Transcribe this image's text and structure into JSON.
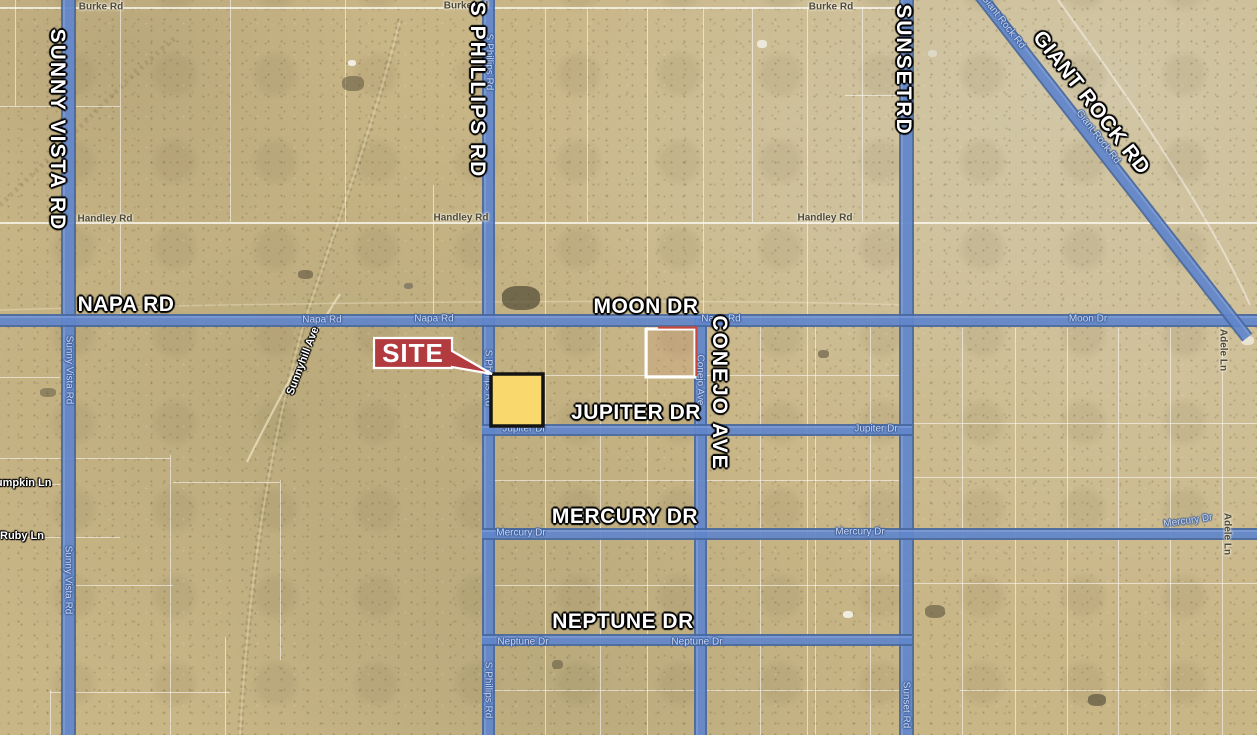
{
  "map": {
    "site_label": "SITE",
    "colors": {
      "desert_base": "#c9b687",
      "road_fill": "#6186cb",
      "road_edge": "#48699f",
      "site_red": "#b23b40",
      "callout_border": "#ffffff",
      "parcel_yellow": "#f9d96d",
      "parcel_yellow_border": "#141414",
      "outlined_parcel_stroke": "#ffffff",
      "outlined_parcel_accent": "#c8473b",
      "grid_white": "#ffffff"
    },
    "major_labels": [
      {
        "text": "SUNNY VISTA RD",
        "x": 57,
        "y": 130,
        "vertical": true
      },
      {
        "text": "S PHILLIPS RD",
        "x": 477,
        "y": 90,
        "vertical": true
      },
      {
        "text": "SUNSETRD",
        "x": 903,
        "y": 70,
        "vertical": true
      },
      {
        "text": "GIANT ROCK RD",
        "x": 1091,
        "y": 103,
        "rotate": 52
      },
      {
        "text": "NAPA RD",
        "x": 126,
        "y": 305
      },
      {
        "text": "MOON DR",
        "x": 646,
        "y": 307
      },
      {
        "text": "JUPITER DR",
        "x": 636,
        "y": 413
      },
      {
        "text": "MERCURY DR",
        "x": 625,
        "y": 517
      },
      {
        "text": "NEPTUNE DR",
        "x": 623,
        "y": 622
      },
      {
        "text": "CONEJO AVE",
        "x": 719,
        "y": 393,
        "vertical": true
      }
    ],
    "minor_road_labels": [
      {
        "text": "Napa Rd",
        "x": 322,
        "y": 320
      },
      {
        "text": "Napa Rd",
        "x": 434,
        "y": 319
      },
      {
        "text": "Napa Rd",
        "x": 721,
        "y": 319
      },
      {
        "text": "Moon Dr",
        "x": 1088,
        "y": 319
      },
      {
        "text": "Jupiter Dr",
        "x": 524,
        "y": 429
      },
      {
        "text": "Jupiter Dr",
        "x": 876,
        "y": 429
      },
      {
        "text": "Mercury Dr",
        "x": 521,
        "y": 533
      },
      {
        "text": "Mercury Dr",
        "x": 860,
        "y": 532
      },
      {
        "text": "Mercury Dr",
        "x": 1188,
        "y": 521,
        "rotate": -8
      },
      {
        "text": "Neptune Dr",
        "x": 523,
        "y": 642
      },
      {
        "text": "Neptune Dr",
        "x": 697,
        "y": 642
      },
      {
        "text": "Sunny Vista Rd",
        "x": 69,
        "y": 370,
        "vertical": true
      },
      {
        "text": "Sunny Vista Rd",
        "x": 68,
        "y": 580,
        "vertical": true
      },
      {
        "text": "S Phillips Rd",
        "x": 489,
        "y": 62,
        "vertical": true
      },
      {
        "text": "S Phillips Rd",
        "x": 488,
        "y": 378,
        "vertical": true
      },
      {
        "text": "S Phillips Rd",
        "x": 488,
        "y": 690,
        "vertical": true
      },
      {
        "text": "Conejo Ave",
        "x": 700,
        "y": 380,
        "vertical": true
      },
      {
        "text": "Sunset Rd",
        "x": 906,
        "y": 705,
        "vertical": true
      },
      {
        "text": "Giant Rock Rd",
        "x": 1003,
        "y": 22,
        "rotate": 52
      },
      {
        "text": "Giant Rock Rd",
        "x": 1098,
        "y": 137,
        "rotate": 52
      }
    ],
    "place_labels": [
      {
        "text": "Burke Rd",
        "x": 101,
        "y": 7
      },
      {
        "text": "Burke Rd",
        "x": 466,
        "y": 6
      },
      {
        "text": "Burke Rd",
        "x": 831,
        "y": 7
      },
      {
        "text": "Handley Rd",
        "x": 105,
        "y": 219
      },
      {
        "text": "Handley Rd",
        "x": 461,
        "y": 218
      },
      {
        "text": "Handley Rd",
        "x": 825,
        "y": 218
      },
      {
        "text": "Adele Ln",
        "x": 1223,
        "y": 350,
        "vertical": true
      },
      {
        "text": "Adele Ln",
        "x": 1227,
        "y": 534,
        "vertical": true
      }
    ],
    "terrain_labels": [
      {
        "text": "Sunnyhill Ave",
        "x": 303,
        "y": 361,
        "rotate": -69
      },
      {
        "text": "Pumpkin Ln",
        "x": 20,
        "y": 483
      },
      {
        "text": "Ruby Ln",
        "x": 22,
        "y": 536
      }
    ],
    "roads": [
      {
        "name": "Sunny Vista Rd",
        "type": "v",
        "x": 61,
        "from": 0,
        "to": 735,
        "w": 15
      },
      {
        "name": "S Phillips Rd",
        "type": "v",
        "x": 482,
        "from": 0,
        "to": 735,
        "w": 13
      },
      {
        "name": "Sunset Rd",
        "type": "v",
        "x": 899,
        "from": 0,
        "to": 735,
        "w": 15
      },
      {
        "name": "Conejo Ave",
        "type": "v",
        "x": 694,
        "from": 314,
        "to": 735,
        "w": 13
      },
      {
        "name": "Napa Rd Moon Dr",
        "type": "h",
        "y": 314,
        "from": 0,
        "to": 1257,
        "w": 13
      },
      {
        "name": "Jupiter Dr",
        "type": "h",
        "y": 424,
        "from": 482,
        "to": 912,
        "w": 12
      },
      {
        "name": "Mercury Dr",
        "type": "h",
        "y": 528,
        "from": 482,
        "to": 1257,
        "w": 12
      },
      {
        "name": "Neptune Dr",
        "type": "h",
        "y": 634,
        "from": 482,
        "to": 912,
        "w": 12
      },
      {
        "name": "Giant Rock Rd",
        "type": "d",
        "x": 984,
        "y": -10,
        "len": 436,
        "angle": 52,
        "w": 13
      }
    ],
    "grid": {
      "h": [
        {
          "y": 7,
          "x1": 0,
          "x2": 905,
          "bright": true
        },
        {
          "y": 106,
          "x1": 0,
          "x2": 120
        },
        {
          "y": 95,
          "x1": 845,
          "x2": 905
        },
        {
          "y": 222,
          "x1": 0,
          "x2": 1257,
          "bright": true
        },
        {
          "y": 375,
          "x1": 490,
          "x2": 905
        },
        {
          "y": 377,
          "x1": 0,
          "x2": 60
        },
        {
          "y": 423,
          "x1": 905,
          "x2": 1257
        },
        {
          "y": 458,
          "x1": 0,
          "x2": 170
        },
        {
          "y": 480,
          "x1": 490,
          "x2": 905
        },
        {
          "y": 477,
          "x1": 905,
          "x2": 1257
        },
        {
          "y": 484,
          "x1": 0,
          "x2": 60
        },
        {
          "y": 482,
          "x1": 173,
          "x2": 280
        },
        {
          "y": 537,
          "x1": 0,
          "x2": 120
        },
        {
          "y": 585,
          "x1": 75,
          "x2": 173
        },
        {
          "y": 585,
          "x1": 490,
          "x2": 905
        },
        {
          "y": 583,
          "x1": 905,
          "x2": 1257
        },
        {
          "y": 690,
          "x1": 490,
          "x2": 905
        },
        {
          "y": 692,
          "x1": 50,
          "x2": 230
        },
        {
          "y": 690,
          "x1": 960,
          "x2": 1257
        }
      ],
      "v": [
        {
          "x": 15,
          "y1": 0,
          "y2": 106
        },
        {
          "x": 120,
          "y1": 0,
          "y2": 314
        },
        {
          "x": 230,
          "y1": 0,
          "y2": 222
        },
        {
          "x": 345,
          "y1": 0,
          "y2": 222
        },
        {
          "x": 433,
          "y1": 185,
          "y2": 314
        },
        {
          "x": 545,
          "y1": 7,
          "y2": 735
        },
        {
          "x": 587,
          "y1": 7,
          "y2": 222
        },
        {
          "x": 647,
          "y1": 7,
          "y2": 735
        },
        {
          "x": 703,
          "y1": 7,
          "y2": 314
        },
        {
          "x": 752,
          "y1": 7,
          "y2": 222
        },
        {
          "x": 807,
          "y1": 7,
          "y2": 735
        },
        {
          "x": 862,
          "y1": 7,
          "y2": 222
        },
        {
          "x": 600,
          "y1": 314,
          "y2": 735
        },
        {
          "x": 760,
          "y1": 314,
          "y2": 735
        },
        {
          "x": 815,
          "y1": 314,
          "y2": 735
        },
        {
          "x": 870,
          "y1": 314,
          "y2": 735
        },
        {
          "x": 170,
          "y1": 455,
          "y2": 735
        },
        {
          "x": 225,
          "y1": 637,
          "y2": 735
        },
        {
          "x": 280,
          "y1": 480,
          "y2": 660
        },
        {
          "x": 50,
          "y1": 690,
          "y2": 735
        },
        {
          "x": 962,
          "y1": 328,
          "y2": 735
        },
        {
          "x": 1015,
          "y1": 328,
          "y2": 735
        },
        {
          "x": 1067,
          "y1": 328,
          "y2": 735
        },
        {
          "x": 1118,
          "y1": 328,
          "y2": 735
        },
        {
          "x": 1170,
          "y1": 328,
          "y2": 735
        },
        {
          "x": 1222,
          "y1": 320,
          "y2": 735
        }
      ]
    },
    "features": [
      {
        "x": 348,
        "y": 60,
        "w": 8,
        "h": 6,
        "c": "#f0ede0"
      },
      {
        "x": 342,
        "y": 76,
        "w": 22,
        "h": 15,
        "c": "rgba(92,84,62,.55)"
      },
      {
        "x": 298,
        "y": 270,
        "w": 15,
        "h": 9,
        "c": "rgba(92,84,62,.6)"
      },
      {
        "x": 404,
        "y": 283,
        "w": 9,
        "h": 6,
        "c": "#8a8068"
      },
      {
        "x": 502,
        "y": 286,
        "w": 38,
        "h": 24,
        "c": "rgba(70,64,45,.65)"
      },
      {
        "x": 757,
        "y": 40,
        "w": 10,
        "h": 8,
        "c": "#ece7d8"
      },
      {
        "x": 928,
        "y": 50,
        "w": 9,
        "h": 7,
        "c": "#ded8c6"
      },
      {
        "x": 818,
        "y": 350,
        "w": 11,
        "h": 8,
        "c": "rgba(92,84,62,.6)"
      },
      {
        "x": 1241,
        "y": 336,
        "w": 13,
        "h": 9,
        "c": "#eae4d2"
      },
      {
        "x": 843,
        "y": 611,
        "w": 10,
        "h": 7,
        "c": "#f0ede0"
      },
      {
        "x": 925,
        "y": 605,
        "w": 20,
        "h": 13,
        "c": "rgba(92,84,62,.6)"
      },
      {
        "x": 1088,
        "y": 694,
        "w": 18,
        "h": 12,
        "c": "rgba(85,78,56,.65)"
      },
      {
        "x": 552,
        "y": 660,
        "w": 11,
        "h": 9,
        "c": "rgba(92,84,62,.55)"
      },
      {
        "x": 40,
        "y": 388,
        "w": 16,
        "h": 9,
        "c": "rgba(92,84,62,.5)"
      }
    ]
  }
}
